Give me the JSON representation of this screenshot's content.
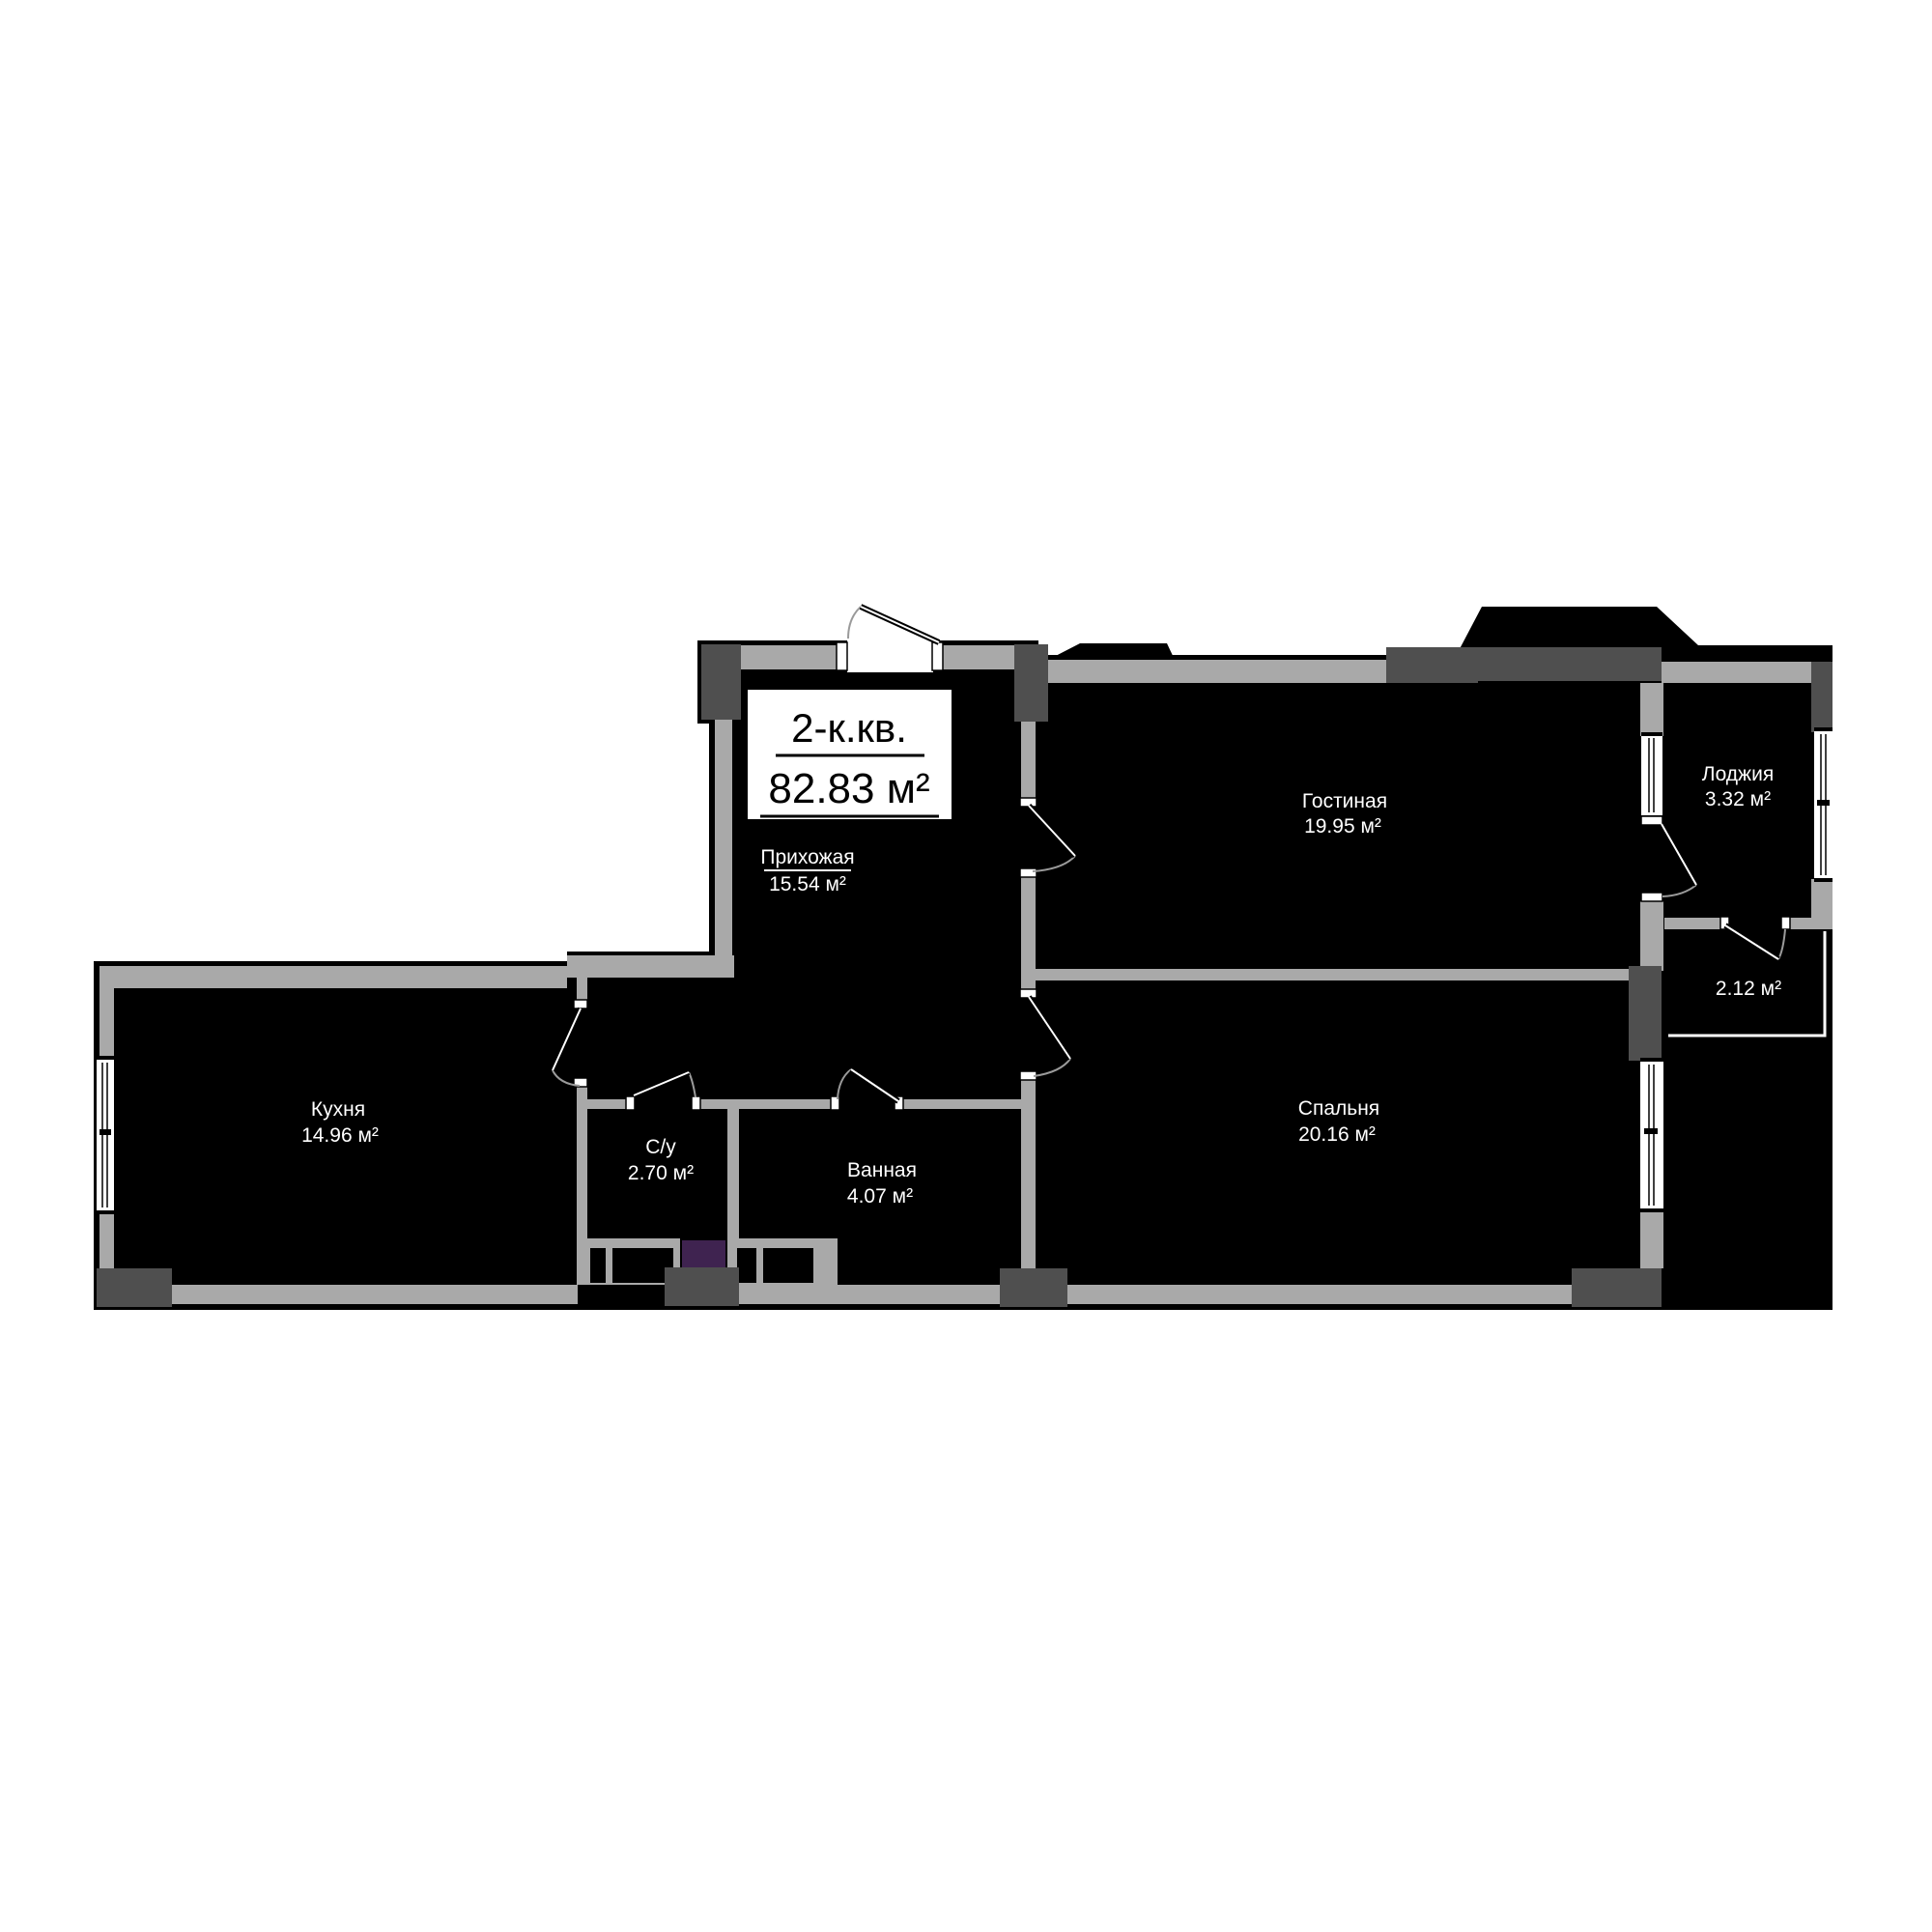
{
  "title": {
    "type_label": "2-к.кв.",
    "area_label": "82.83 м²"
  },
  "rooms": {
    "hallway": {
      "name": "Прихожая",
      "area": "15.54 м²"
    },
    "living": {
      "name": "Гостиная",
      "area": "19.95 м²"
    },
    "loggia": {
      "name": "Лоджия",
      "area": "3.32 м²"
    },
    "balcony": {
      "area": "2.12 м²"
    },
    "kitchen": {
      "name": "Кухня",
      "area": "14.96 м²"
    },
    "wc": {
      "name": "С/у",
      "area": "2.70 м²"
    },
    "bathroom": {
      "name": "Ванная",
      "area": "4.07 м²"
    },
    "bedroom": {
      "name": "Спальня",
      "area": "20.16 м²"
    }
  },
  "colors": {
    "wall_gray": "#a9a9a9",
    "dark_gray": "#4f4f4f",
    "floor_black": "#000000",
    "background": "#ffffff",
    "shaft_purple": "#3f2350",
    "door_arc_gray": "#9a9a9a"
  }
}
